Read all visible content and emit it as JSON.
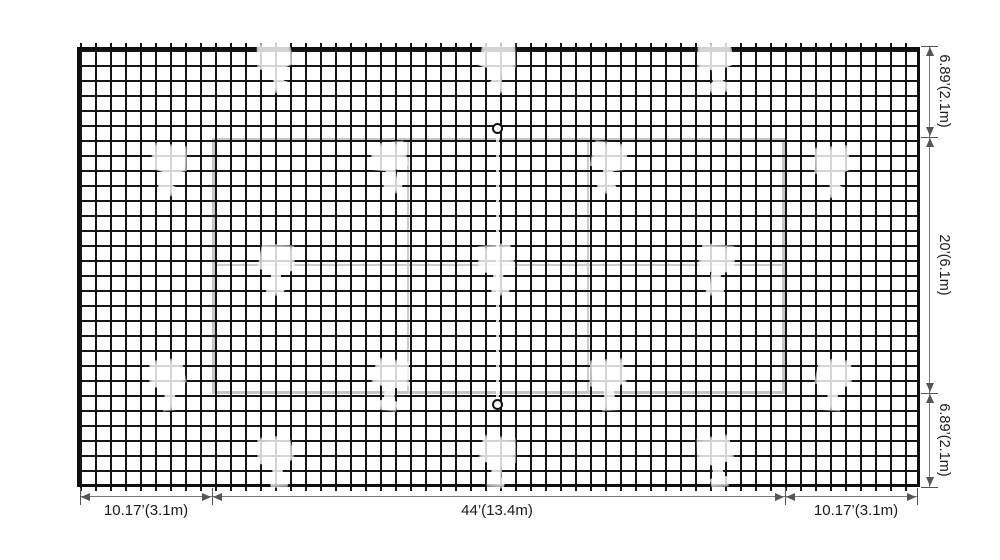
{
  "diagram": {
    "title": "badminton court net plan",
    "watermark_icon": "shuttlecock-watermark",
    "bottom_dimensions": [
      {
        "label": "10.17’(3.1m)"
      },
      {
        "label": "44’(13.4m)"
      },
      {
        "label": "10.17’(3.1m)"
      }
    ],
    "right_dimensions": [
      {
        "label": "6.89’(2.1m)"
      },
      {
        "label": "20’(6.1m)"
      },
      {
        "label": "6.89’(2.1m)"
      }
    ],
    "colors": {
      "background": "#ffffff",
      "mesh": "#161616",
      "court_line": "#c6c6c6",
      "dimension_line": "#787878",
      "text": "#1a1a1a"
    }
  }
}
